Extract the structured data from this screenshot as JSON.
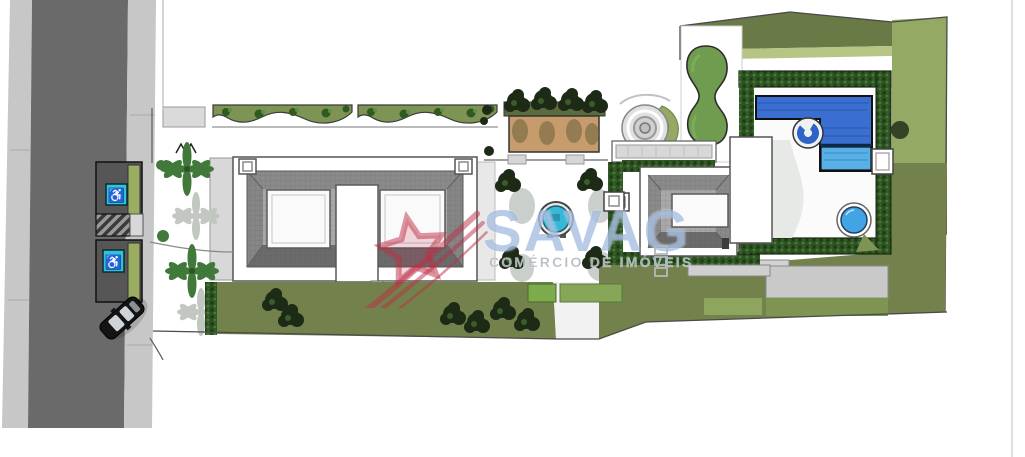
{
  "image": {
    "type": "architectural-site-plan-rendering",
    "view": "top-down"
  },
  "watermark": {
    "brand": "SAVAG",
    "tagline": "COMÉRCIO DE IMÓVEIS"
  },
  "icons": {
    "accessible_parking": "♿"
  },
  "colors": {
    "road": "#6a6a6a",
    "sidewalk": "#c7c7c7",
    "parking": "#565656",
    "teal": "#2fc4cf",
    "lawn": "#73814d",
    "lawnMed": "#93a964",
    "lawnLight": "#b6c583",
    "lawnBright": "#7cab4c",
    "hedge": "#2e5323",
    "tree": "#1c2a16",
    "palm": "#41793a",
    "shadow": "#c2c7c2",
    "bed": "#7d9454",
    "tan": "#c69c6d",
    "roof": "#9c9c9c",
    "roofDark": "#6b6b6b",
    "roofMid": "#8a8a8a",
    "roofLight": "#b3b3b3",
    "patio": "#c9c9c9",
    "poolDark": "#3a6ed0",
    "poolLight": "#57b0e6",
    "spa": "#42a4e4",
    "fountain": "#38b8d8",
    "wmBlue": "rgba(125,162,214,0.55)",
    "wmGray": "rgba(178,184,190,0.92)",
    "wmRed": "rgba(190,45,70,0.5)"
  }
}
